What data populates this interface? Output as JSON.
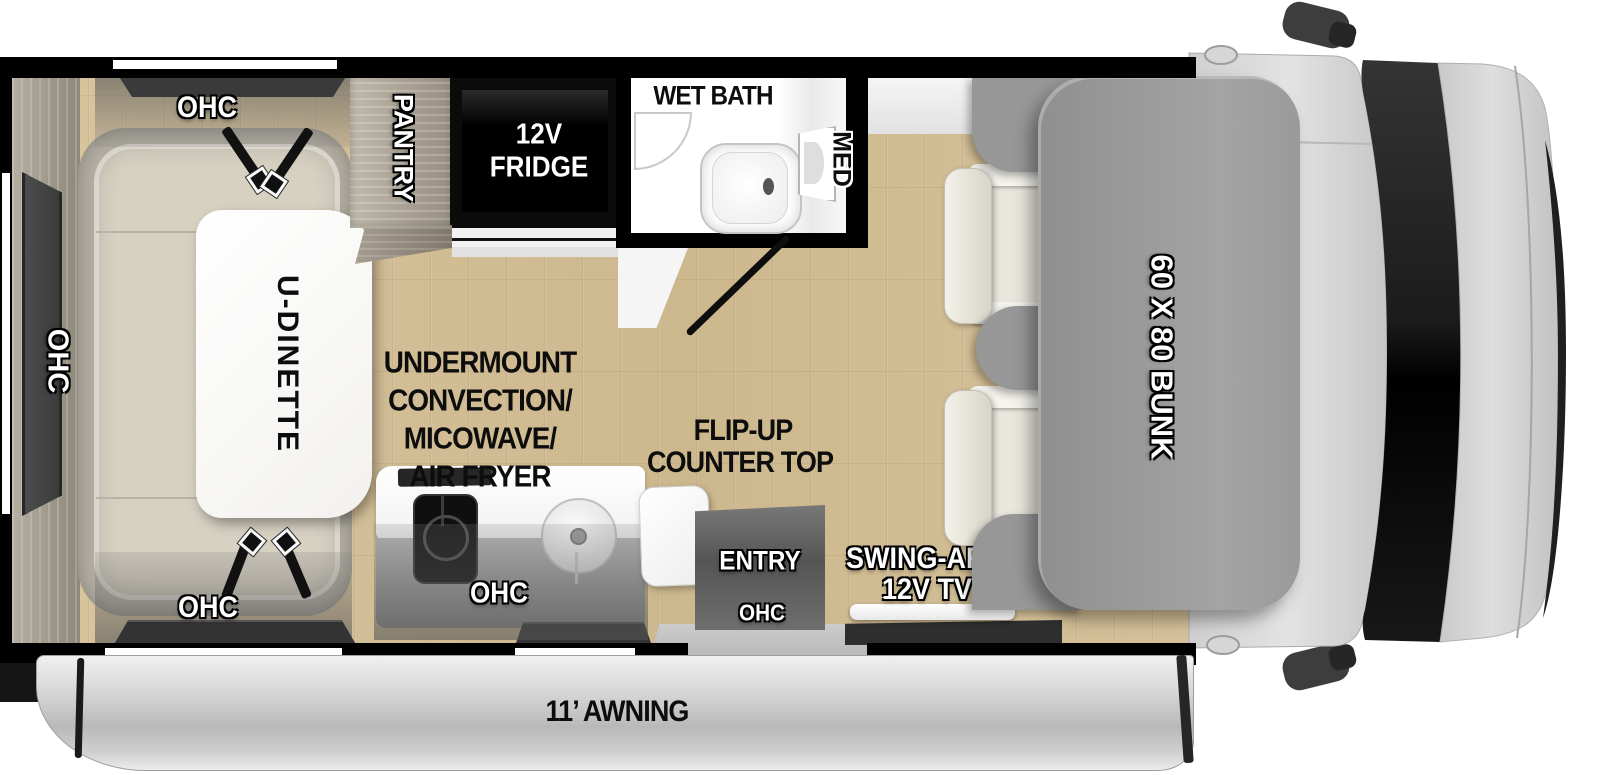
{
  "labels": {
    "ohc": "OHC",
    "pantry": "PANTRY",
    "fridge_line1": "12V",
    "fridge_line2": "FRIDGE",
    "wet_bath": "WET BATH",
    "med": "MED",
    "u_dinette": "U-DINETTE",
    "undermount_line1": "UNDERMOUNT",
    "undermount_line2": "CONVECTION/",
    "undermount_line3": "MICOWAVE/",
    "undermount_line4": "AIR FRYER",
    "flip_up_line1": "FLIP-UP",
    "flip_up_line2": "COUNTER TOP",
    "entry": "ENTRY",
    "tv_line1": "SWING-ARM",
    "tv_line2": "12V TV",
    "bunk": "60 X 80 BUNK",
    "awning": "11’ AWNING"
  },
  "colors": {
    "wall": "#000000",
    "floor_wood": "#d2bd95",
    "bunk_gray": "#9b9b9b",
    "awning_gray": "#cfcfcf",
    "cushion_beige": "#d7d1c2",
    "fridge_black": "#0b0b0b"
  }
}
